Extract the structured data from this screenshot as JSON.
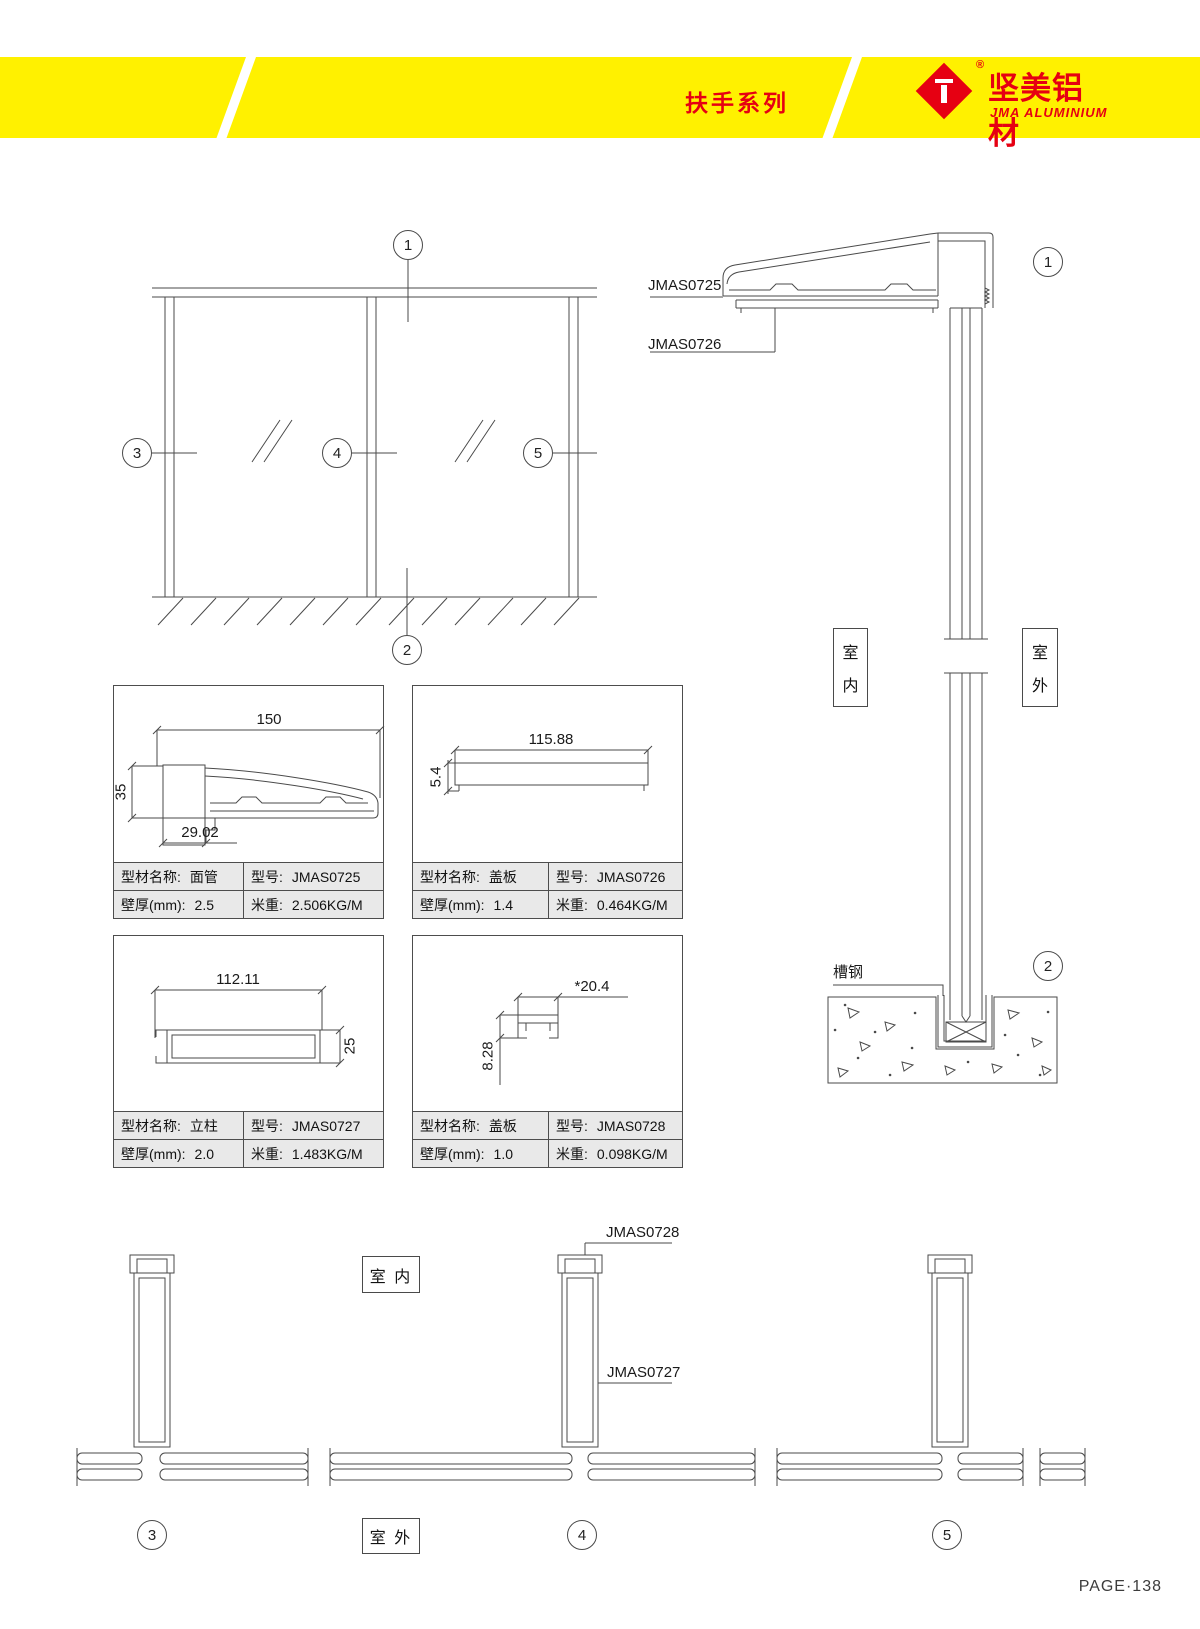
{
  "header": {
    "series_title": "扶手系列",
    "brand_name": "坚美铝材",
    "brand_subtitle": "JMA ALUMINIUM",
    "registered_mark": "®",
    "band_color": "#FFF100",
    "accent_color": "#E60012"
  },
  "callouts": {
    "n1": "1",
    "n2": "2",
    "n3": "3",
    "n4": "4",
    "n5": "5"
  },
  "labels": {
    "indoor_char_top": "室",
    "indoor_char_bottom": "内",
    "outdoor_char_top": "室",
    "outdoor_char_bottom": "外",
    "indoor_horizontal": "室 内",
    "outdoor_horizontal": "室 外",
    "channel_steel": "槽钢",
    "rail_profile": "JMAS0725",
    "rail_cover": "JMAS0726",
    "post_profile": "JMAS0727",
    "post_cover": "JMAS0728"
  },
  "profiles": [
    {
      "name_label": "型材名称:",
      "name": "面管",
      "model_label": "型号:",
      "model": "JMAS0725",
      "thickness_label": "壁厚(mm):",
      "thickness": "2.5",
      "weight_label": "米重:",
      "weight": "2.506KG/M",
      "dim_width": "150",
      "dim_height": "35",
      "dim_extra": "29.02"
    },
    {
      "name_label": "型材名称:",
      "name": "盖板",
      "model_label": "型号:",
      "model": "JMAS0726",
      "thickness_label": "壁厚(mm):",
      "thickness": "1.4",
      "weight_label": "米重:",
      "weight": "0.464KG/M",
      "dim_width": "115.88",
      "dim_height": "5.4"
    },
    {
      "name_label": "型材名称:",
      "name": "立柱",
      "model_label": "型号:",
      "model": "JMAS0727",
      "thickness_label": "壁厚(mm):",
      "thickness": "2.0",
      "weight_label": "米重:",
      "weight": "1.483KG/M",
      "dim_width": "112.11",
      "dim_height": "25"
    },
    {
      "name_label": "型材名称:",
      "name": "盖板",
      "model_label": "型号:",
      "model": "JMAS0728",
      "thickness_label": "壁厚(mm):",
      "thickness": "1.0",
      "weight_label": "米重:",
      "weight": "0.098KG/M",
      "dim_width": "*20.4",
      "dim_height": "8.28"
    }
  ],
  "footer": {
    "page": "PAGE·138"
  }
}
